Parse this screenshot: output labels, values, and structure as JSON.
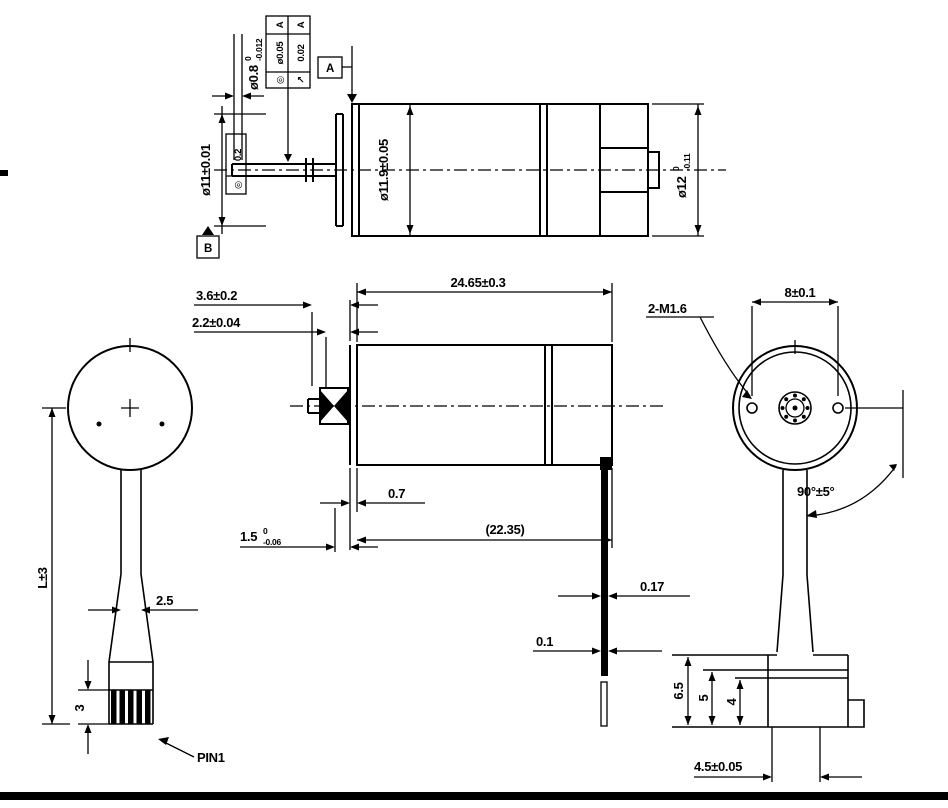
{
  "meta": {
    "colors": {
      "ink": "#000000",
      "paper": "#ffffff"
    },
    "drawing_type": "gearmotor 4-view dimensioned drawing"
  },
  "top_view": {
    "dim_shaft_dia": {
      "main": "ø0.8",
      "tol_sup": "0",
      "tol_sub": "-0.012"
    },
    "gdt_frame": {
      "rows": [
        {
          "symbol": "◎",
          "value": "ø0.05",
          "datum": "A"
        },
        {
          "symbol": "↗",
          "value": "0.02",
          "datum": "A"
        }
      ]
    },
    "datum_a": "A",
    "datum_b": "B",
    "dim_front_dia": "ø11±0.01",
    "gdt_runout": {
      "symbol": "◎",
      "value": "0.2"
    },
    "dim_gearbox_dia": "ø11.9±0.05",
    "dim_motor_dia": {
      "main": "ø12",
      "tol_sup": "0",
      "tol_sub": "-0.11"
    }
  },
  "side_view": {
    "dim_pinion_len": "3.6±0.2",
    "dim_pinion_hub": "2.2±0.04",
    "dim_body_len": "24.65±0.3",
    "dim_plate_thk": "0.7",
    "dim_ref_len": "(22.35)",
    "dim_shaft_len": {
      "main": "1.5",
      "tol_sup": "0",
      "tol_sub": "-0.06"
    },
    "dim_tab_thk": "0.17",
    "dim_tab_off": "0.1"
  },
  "front_view": {
    "dim_wire_len": "L±3",
    "dim_wire_width": "2.5",
    "dim_connector_h": "3",
    "pin_label": "PIN1"
  },
  "rear_view": {
    "dim_hole_span": "8±0.1",
    "thread_note": "2-M1.6",
    "dim_angle": "90°±5°",
    "dim_conn_65": "6.5",
    "dim_conn_5": "5",
    "dim_conn_4": "4",
    "dim_conn_pitch": "4.5±0.05"
  }
}
